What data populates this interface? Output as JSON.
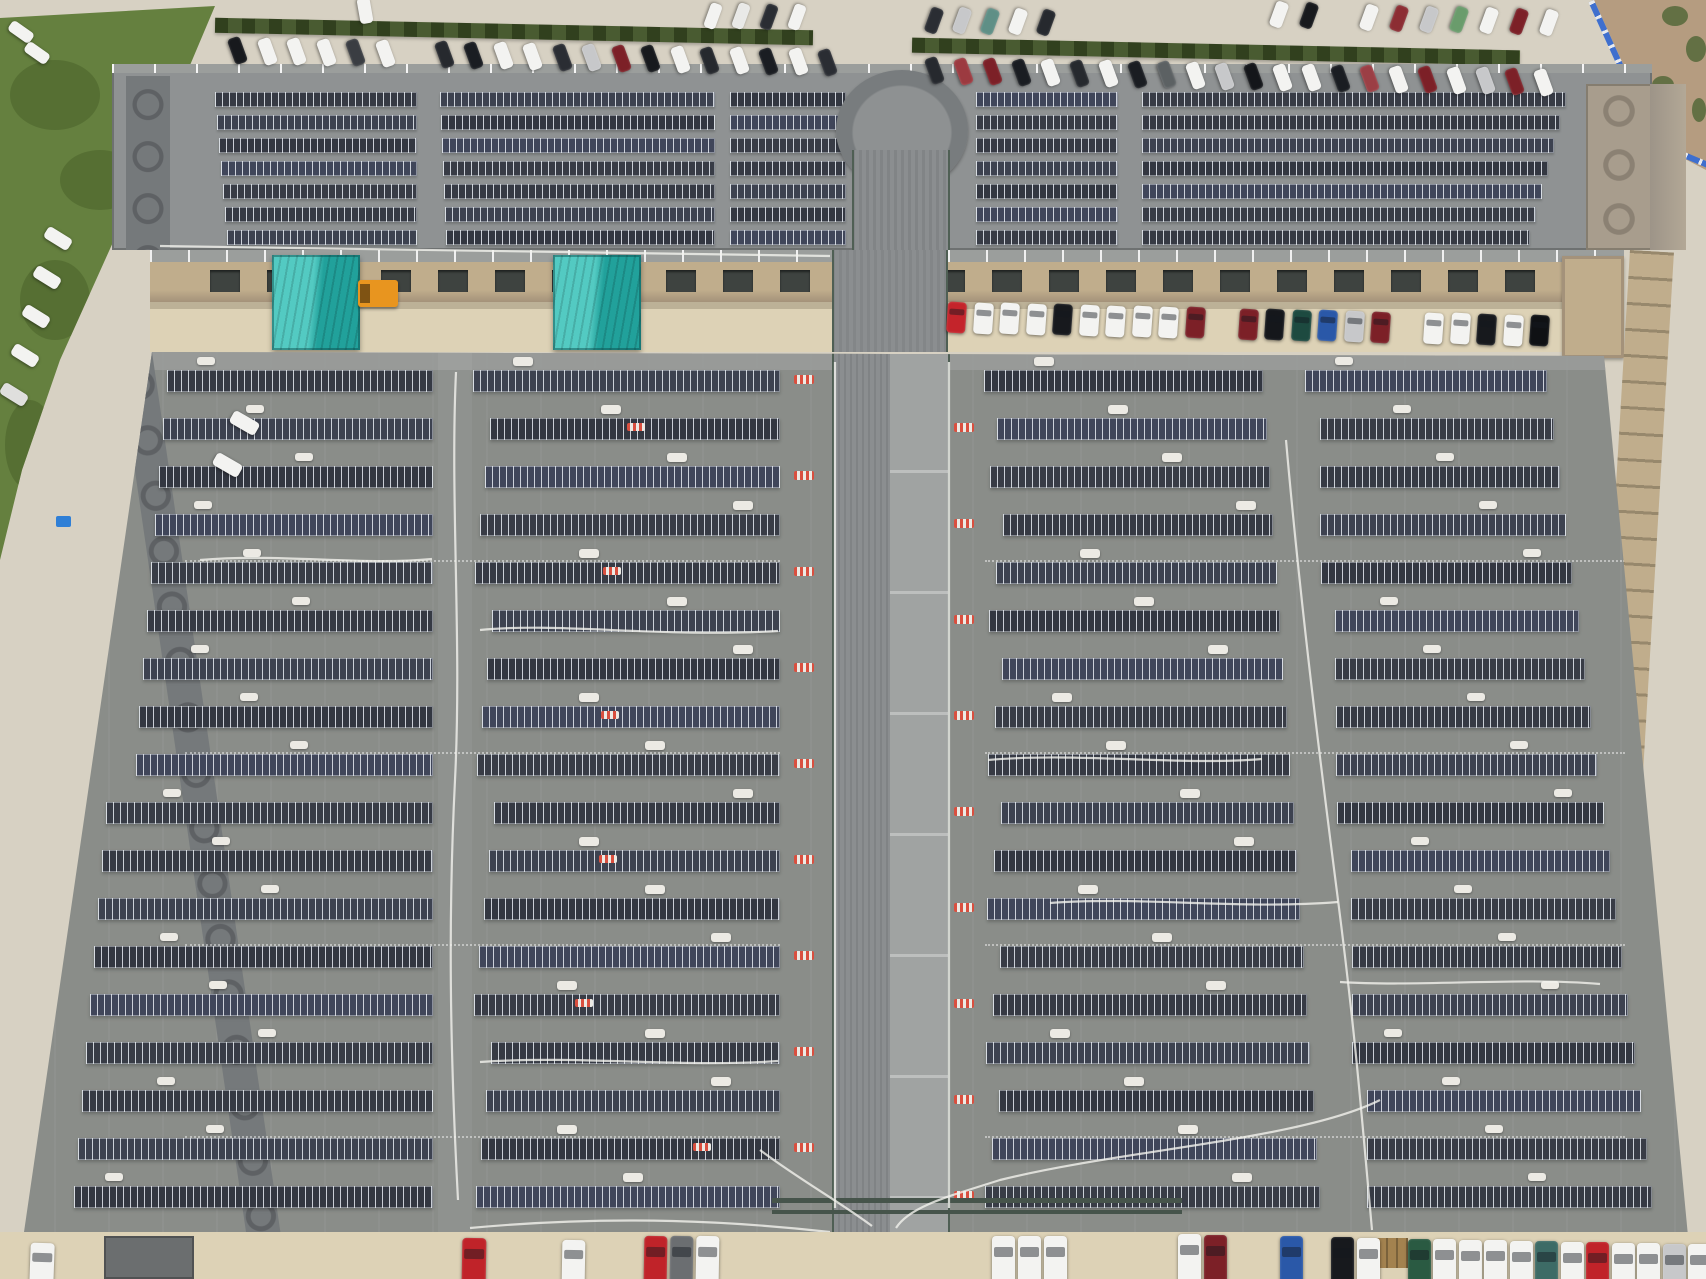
{
  "scene": {
    "description": "Aerial drone photograph of a large factory complex with rooftop solar panel arrays, a central covered corridor, teal skylight structures, perimeter parking lots full of cars, grass verge and a blue construction fence",
    "type": "aerial-photo",
    "canvas": {
      "width": 1706,
      "height": 1279
    }
  },
  "palette": {
    "concrete": "#d7d1c3",
    "concrete_light": "#ded8ca",
    "apron_tan": "#ddd2b6",
    "grass": "#65803f",
    "grass_dark": "#50682f",
    "hedge": "#3f5226",
    "dirt": "#b59c80",
    "weeds": "#55683a",
    "fence_blue": "#3f6fce",
    "fence_post": "#e8eaee",
    "roof_upper": "#8f9293",
    "roof_lower": "#8a8d89",
    "roof_walkway": "#9b9e9c",
    "corridor_rib": "#8b8e90",
    "corridor_smooth": "#a0a3a2",
    "corridor_edge": "#4f5f54",
    "panel_shades": [
      "#363a44",
      "#3d4250",
      "#333741",
      "#40465a",
      "#383c46"
    ],
    "panel_seam": "rgba(228,233,240,0.85)",
    "wall_band": "#75797b",
    "wall_arch": "#5e6164",
    "corner_tan": "#a89d8d",
    "corner_arch": "#8b8173",
    "facade_tan": "#c0ad8c",
    "facade_shadow": "#a4927a",
    "window_dark": "#3e4340",
    "teal_light": "#53cac2",
    "teal_dark": "#21a19b",
    "orange": "#e8951f",
    "cable_white": "#f2f2ee",
    "vent_white": "#eceae4",
    "vent_red": "#d94f3f",
    "pipe_green": "#46544b",
    "dock_gray": "#6b6e6f",
    "crate_tan": "#a3824f",
    "tarp_blue": "#2f7fd6",
    "car_white": "#f3f3f1",
    "car_silver": "#c7c8ca",
    "car_black": "#17191d",
    "car_gray": "#3a3d42",
    "car_red": "#c02329",
    "car_darkred": "#7c2027",
    "car_blue": "#2a58a8",
    "car_green": "#2a5a42",
    "car_teal": "#3d6b66"
  },
  "ground": {
    "grass_points": [
      [
        0,
        18
      ],
      [
        215,
        6
      ],
      [
        150,
        160
      ],
      [
        60,
        360
      ],
      [
        22,
        470
      ],
      [
        0,
        560
      ]
    ],
    "grass_patches": [
      [
        10,
        60,
        90,
        70
      ],
      [
        60,
        150,
        80,
        60
      ],
      [
        20,
        260,
        70,
        80
      ],
      [
        5,
        400,
        50,
        90
      ]
    ],
    "dirt_points": [
      [
        1594,
        0
      ],
      [
        1706,
        0
      ],
      [
        1706,
        170
      ],
      [
        1660,
        146
      ]
    ],
    "weeds": [
      [
        1662,
        6,
        26,
        20
      ],
      [
        1686,
        36,
        20,
        26
      ],
      [
        1652,
        76,
        22,
        18
      ],
      [
        1692,
        98,
        14,
        24
      ]
    ],
    "fence_segments": [
      {
        "x": 1594,
        "y": 0,
        "len": 160,
        "angle": 65.7
      },
      {
        "x": 1656,
        "y": 140,
        "len": 58,
        "angle": 22.8
      }
    ]
  },
  "hedges": [
    {
      "x": 215,
      "y": 24,
      "w": 598,
      "h": 15,
      "angle": 1.2
    },
    {
      "x": 912,
      "y": 44,
      "w": 608,
      "h": 15,
      "angle": 1.2
    }
  ],
  "upper_roof": {
    "x1": 112,
    "y1": 66,
    "x2": 1652,
    "y2": 250,
    "rows": 7,
    "row_y0": 92,
    "row_dy": 23,
    "row_h": 15,
    "fields": [
      {
        "x1": 215,
        "x2": 417,
        "ss": 2,
        "se": 0
      },
      {
        "x1": 440,
        "x2": 715,
        "ss": 1,
        "se": 0
      },
      {
        "x1": 730,
        "x2": 846,
        "ss": 0,
        "se": 0
      },
      {
        "x1": 976,
        "x2": 1118,
        "ss": 0,
        "se": 0
      },
      {
        "x1": 1142,
        "x2": 1566,
        "ss": 0,
        "se": 6
      }
    ],
    "west_band": {
      "x": 126,
      "y": 76,
      "w": 44,
      "h": 174
    },
    "corner_block": {
      "x": 1586,
      "y": 84,
      "w": 66,
      "h": 166
    },
    "east_band": {
      "x": 1650,
      "y": 84,
      "w": 36,
      "h": 166
    },
    "circle": {
      "x": 836,
      "y": 70,
      "w": 132,
      "h": 120
    },
    "corridor": {
      "x": 852,
      "y": 150,
      "w": 98,
      "h": 100
    }
  },
  "middle_strip": {
    "x1": 150,
    "x2": 1624,
    "y1": 250,
    "y2": 352,
    "walkway_h": 12,
    "facade_y": 262,
    "facade_h": 40,
    "apron_y": 302,
    "windows": {
      "y": 270,
      "w": 30,
      "h": 22,
      "left": {
        "start": 210,
        "end": 800,
        "step": 57
      },
      "right": {
        "start": 935,
        "end": 1545,
        "step": 57
      }
    },
    "teal_structures": [
      {
        "x": 272,
        "y": 255,
        "w": 88,
        "h": 95
      },
      {
        "x": 553,
        "y": 255,
        "w": 88,
        "h": 95
      }
    ],
    "orange_vehicle": {
      "x": 358,
      "y": 280,
      "w": 40,
      "h": 27
    },
    "stair_tower": {
      "x": 1562,
      "y": 256,
      "w": 62,
      "h": 102
    },
    "corridor_bridge": {
      "x": 832,
      "w": 116
    }
  },
  "lower_roof": {
    "poly": [
      [
        152,
        352
      ],
      [
        1604,
        356
      ],
      [
        1688,
        1236
      ],
      [
        24,
        1232
      ]
    ],
    "rows": 18,
    "row_y0": 370,
    "row_dy": 48,
    "row_h": 22,
    "left_edge": {
      "x_top": 158,
      "slope": 0.1455
    },
    "sections": {
      "a_end": 433,
      "aisle1": [
        438,
        472
      ],
      "b_x1": 473,
      "b_x2": 780,
      "c_x1": 984,
      "c_end_base": 1262,
      "c_end_slope": 0.07,
      "d_gap": 42,
      "d_end_base": 1545,
      "d_end_slope": 0.13,
      "d_end_max": 1652
    },
    "corridor": {
      "rib_x": 832,
      "rib_w": 58,
      "smooth_x": 890,
      "smooth_w": 60,
      "y1": 352,
      "y2": 1232
    },
    "west_band": {
      "x": 118,
      "y": 352,
      "w": 34,
      "h": 892,
      "angle": -8.3
    },
    "dash_ys": [
      560,
      752,
      944,
      1136
    ],
    "pipes": [
      {
        "x": 772,
        "y": 1198,
        "w": 410,
        "h": 5
      },
      {
        "x": 772,
        "y": 1210,
        "w": 410,
        "h": 4
      }
    ]
  },
  "east_wall_band": {
    "x": 1630,
    "y": 250,
    "w": 44,
    "h": 1000,
    "angle": 3.4
  },
  "bottom": {
    "apron_y": 1232,
    "dock": {
      "x": 104,
      "y": 1236,
      "w": 90,
      "h": 43
    },
    "crates": {
      "x": 1366,
      "y": 1238,
      "w": 42,
      "h": 30
    }
  },
  "tarp": {
    "x": 56,
    "y": 516,
    "w": 15,
    "h": 11
  },
  "cables": [
    "M456,372 C450,500 462,640 455,780 S450,1050 458,1200",
    "M949,362 L949,1208",
    "M835,362 L835,1208",
    "M1286,440 C1300,600 1320,760 1338,900 S1362,1120 1372,1230",
    "M1338,902 C1240,910 1140,896 1050,903",
    "M1340,982 C1420,987 1520,977 1600,984",
    "M480,630 C560,622 660,638 778,631",
    "M480,1062 C580,1055 680,1068 778,1061",
    "M200,560 C280,553 360,566 432,559",
    "M988,760 C1080,752 1180,766 1262,759",
    "M1380,1100 C1300,1140 1120,1150 1000,1180 C950,1196 910,1206 896,1228",
    "M760,1150 C800,1180 840,1202 872,1226",
    "M160,246 L830,256",
    "M470,1228 C620,1214 740,1222 830,1232"
  ],
  "car_clusters": [
    {
      "name": "top-row-left",
      "x": 224,
      "y": 44,
      "dx": 29.5,
      "dy": 0.6,
      "w": 27,
      "h": 13,
      "angle": 70,
      "colors": [
        "#17191d",
        "#f3f3f1",
        "#f3f3f1",
        "#f3f3f1",
        "#3a3d42",
        "#f3f3f1",
        "",
        "#26292e",
        "#1a1d22",
        "#f3f3f1",
        "#f3f3f1",
        "#2a2d33",
        "#c7c8ca",
        "#7c2027",
        "#17191d",
        "#f3f3f1",
        "#26292e",
        "#f3f3f1",
        "#1a1d22",
        "#f3f3f1",
        "#2a2d33"
      ]
    },
    {
      "name": "top-row-right",
      "x": 921,
      "y": 64,
      "dx": 29,
      "dy": 0.55,
      "w": 27,
      "h": 13,
      "angle": 70,
      "colors": [
        "#26292e",
        "#9c3a40",
        "#7c2027",
        "#1a1d22",
        "#f3f3f1",
        "#26292e",
        "#f3f3f1",
        "#1a1d22",
        "#5c6163",
        "#f3f3f1",
        "#c7c8ca",
        "#14161a",
        "#f3f3f1",
        "#f3f3f1",
        "#1a1d22",
        "#9b3f45",
        "#f3f3f1",
        "#7c2027",
        "#f3f3f1",
        "#c7c8ca",
        "#7c2027",
        "#f3f3f1"
      ]
    },
    {
      "name": "top-upper-left-cluster",
      "x": 700,
      "y": 10,
      "dx": 28,
      "dy": 0.3,
      "w": 26,
      "h": 12,
      "angle": 110,
      "colors": [
        "#f3f3f1",
        "#e9e9e7",
        "#2a2d33",
        "#f3f3f1"
      ]
    },
    {
      "name": "top-upper-mid-cluster",
      "x": 921,
      "y": 14,
      "dx": 28,
      "dy": 0.4,
      "w": 26,
      "h": 13,
      "angle": 110,
      "colors": [
        "#2a2d33",
        "#c7c8ca",
        "#5f8f86",
        "#f3f3f1",
        "#26292e"
      ]
    },
    {
      "name": "top-upper-right-cluster",
      "x": 1266,
      "y": 8,
      "dx": 30,
      "dy": 0.9,
      "w": 26,
      "h": 13,
      "angle": 110,
      "colors": [
        "#f3f3f1",
        "#17191d",
        "",
        "#f3f3f1",
        "#8c2d33",
        "#c7c8ca",
        "#6a9c6c",
        "#f3f3f1",
        "#7c2027",
        "#f3f3f1"
      ]
    },
    {
      "name": "top-left-singles",
      "x": 8,
      "y": 26,
      "dx": 16,
      "dy": 21,
      "w": 26,
      "h": 12,
      "angle": 35,
      "colors": [
        "#f3f3f1",
        "#f3f3f1"
      ]
    },
    {
      "name": "top-lone-white",
      "x": 352,
      "y": 4,
      "dx": 0,
      "dy": 0,
      "w": 26,
      "h": 13,
      "angle": 80,
      "colors": [
        "#f3f3f1"
      ]
    },
    {
      "name": "west-road-column",
      "x": 44,
      "y": 232,
      "dx": -11,
      "dy": 39,
      "w": 28,
      "h": 13,
      "angle": 32,
      "colors": [
        "#f3f3f1",
        "#f3f3f1",
        "#f3f3f1",
        "#f3f3f1",
        "#dfdfdd"
      ]
    },
    {
      "name": "west-road-pair",
      "x": 230,
      "y": 416,
      "dx": -17,
      "dy": 42,
      "w": 29,
      "h": 14,
      "angle": 30,
      "colors": [
        "#f3f3f1",
        "#f3f3f1"
      ]
    },
    {
      "name": "courtyard-row",
      "x": 947,
      "y": 302,
      "dx": 26.5,
      "dy": 0.6,
      "w": 19,
      "h": 31,
      "angle": 4,
      "colors": [
        "#c4242b",
        "#f3f3f1",
        "#f3f3f1",
        "#f3f3f1",
        "#17191d",
        "#f3f3f1",
        "#f3f3f1",
        "#f3f3f1",
        "#f3f3f1",
        "#7c2027",
        "",
        "#7c2027",
        "#15171b",
        "#1d4a40",
        "#2a58a8",
        "#c7c8ca",
        "#7c2027",
        "",
        "#f3f3f1",
        "#f3f3f1",
        "#17191d",
        "#f3f3f1",
        "#0f1114"
      ]
    },
    {
      "name": "bottom-corner-white",
      "x": 30,
      "y": 1243,
      "dx": 0,
      "dy": 0,
      "w": 24,
      "h": 44,
      "angle": 2,
      "colors": [
        "#f3f3f1"
      ]
    },
    {
      "name": "bottom-red-single",
      "x": 462,
      "y": 1238,
      "dx": 0,
      "dy": 0,
      "w": 24,
      "h": 48,
      "angle": 1,
      "colors": [
        "#c02329"
      ]
    },
    {
      "name": "bottom-white-single",
      "x": 562,
      "y": 1240,
      "dx": 0,
      "dy": 0,
      "w": 23,
      "h": 46,
      "angle": 1,
      "colors": [
        "#f3f3f1"
      ]
    },
    {
      "name": "bottom-mid-left-group",
      "x": 644,
      "y": 1236,
      "dx": 26,
      "dy": 0,
      "w": 23,
      "h": 48,
      "angle": 1,
      "colors": [
        "#c02329",
        "#6b6e71",
        "#f3f3f1"
      ]
    },
    {
      "name": "bottom-mid-right-group",
      "x": 992,
      "y": 1236,
      "dx": 26,
      "dy": 0,
      "w": 23,
      "h": 48,
      "angle": 0,
      "colors": [
        "#f3f3f1",
        "#f3f3f1",
        "#f3f3f1"
      ]
    },
    {
      "name": "bottom-right-row",
      "x": 1178,
      "y": 1234,
      "dx": 25.5,
      "dy": 0.5,
      "w": 23,
      "h": 50,
      "angle": 0,
      "colors": [
        "#f3f3f1",
        "#7c2027",
        "",
        "",
        "#2a58a8",
        "",
        "#17191d",
        "#f3f3f1",
        "",
        "#2a5a42",
        "#f3f3f1",
        "#f3f3f1",
        "#f3f3f1",
        "#f3f3f1",
        "#3d6b66",
        "#f3f3f1",
        "#c02329",
        "#f3f3f1",
        "#f3f3f1",
        "#c7c8ca",
        "#f3f3f1"
      ]
    }
  ]
}
